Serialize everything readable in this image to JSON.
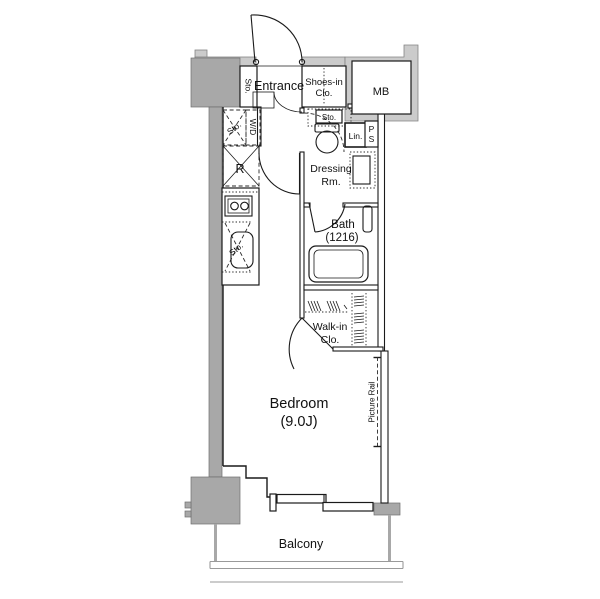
{
  "colors": {
    "background": "#ffffff",
    "exterior_wall_band": "#cbcbcb",
    "structural_pillar": "#a8a8a8",
    "plan_line": "#1a1a1a",
    "balcony_line": "#9a9a9a"
  },
  "labels": {
    "entrance": "Entrance",
    "storage_entrance": "Sto.",
    "shoes_closet_line1": "Shoes-in",
    "shoes_closet_line2": "Clo.",
    "meter_box": "MB",
    "storage_wd_area": "Sto.",
    "washer_dryer": "W/D",
    "refrigerator": "R",
    "storage_toilet": "Sto.",
    "linen": "Lin.",
    "pipe_space_line1": "P",
    "pipe_space_line2": "S",
    "dressing_room_line1": "Dressing",
    "dressing_room_line2": "Rm.",
    "bath_line1": "Bath",
    "bath_line2": "(1216)",
    "storage_kitchen": "Sto.",
    "walk_in_closet_line1": "Walk-in",
    "walk_in_closet_line2": "Clo.",
    "bedroom_line1": "Bedroom",
    "bedroom_line2": "(9.0J)",
    "picture_rail": "Picture Rail",
    "balcony": "Balcony"
  }
}
